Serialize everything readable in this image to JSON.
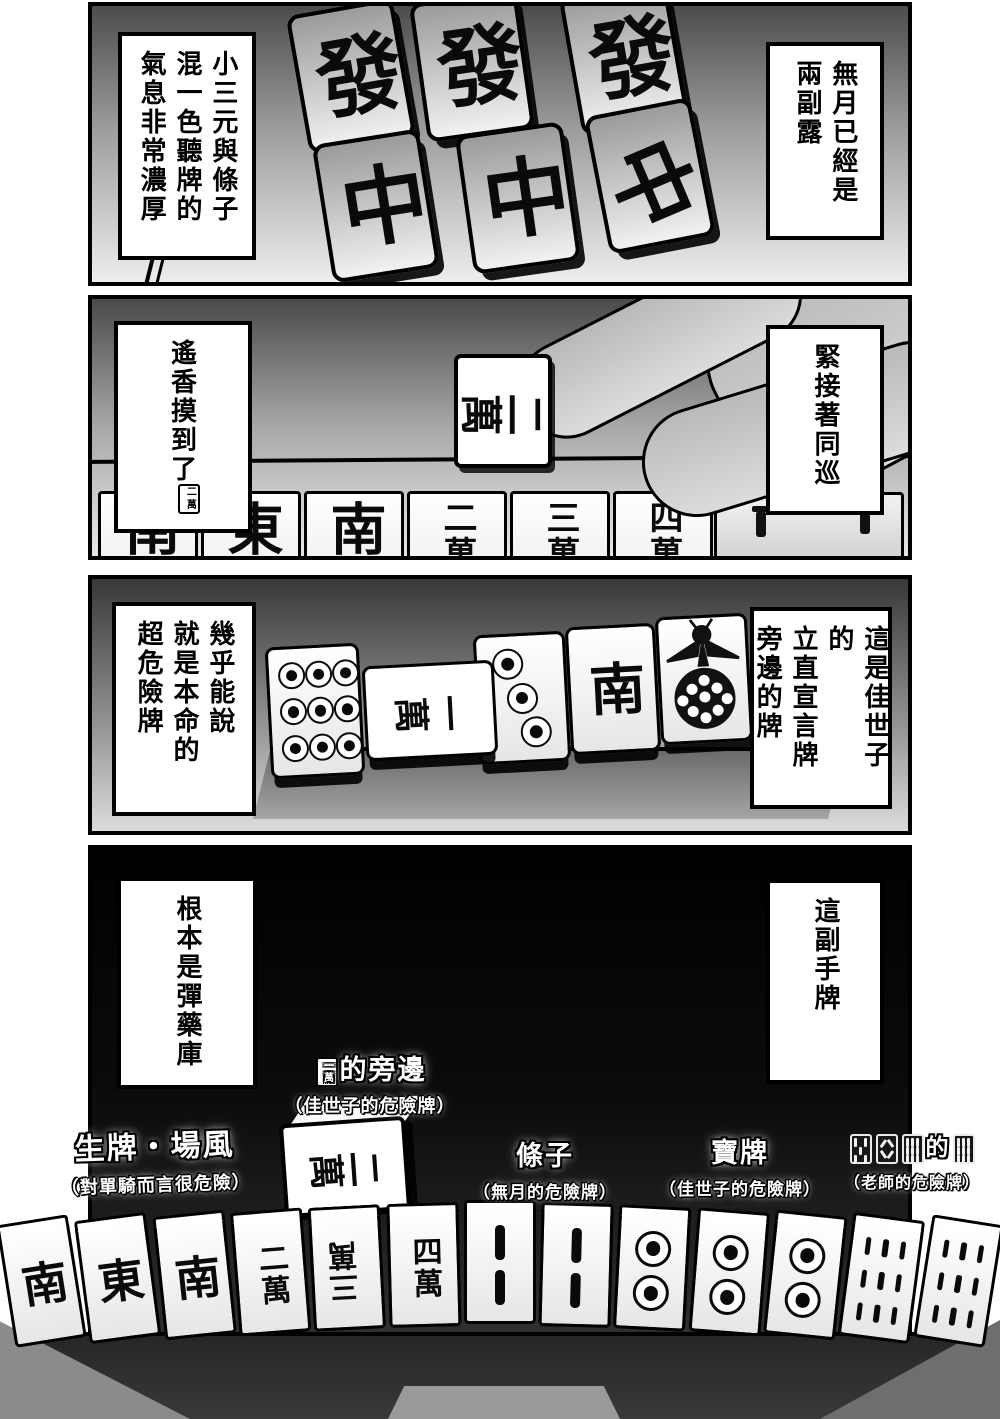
{
  "colors": {
    "ink": "#000000",
    "paper": "#ffffff",
    "panel4_bg": "#000000",
    "label_text": "#ffffff"
  },
  "panel1": {
    "caption_right": "無月已經是\n兩副露",
    "caption_left": "小三元與條子\n混一色聽牌的\n氣息非常濃厚",
    "tiles": [
      {
        "suit": "dragon",
        "label": "發"
      },
      {
        "suit": "dragon",
        "label": "發"
      },
      {
        "suit": "dragon",
        "label": "發"
      },
      {
        "suit": "dragon",
        "label": "中"
      },
      {
        "suit": "dragon",
        "label": "中"
      },
      {
        "suit": "dragon",
        "label": "中"
      }
    ]
  },
  "panel2": {
    "caption_right": "緊接著同巡",
    "caption_left_text": "遙香摸到了",
    "caption_left_icon": {
      "suit": "man",
      "label": "二萬"
    },
    "drawn_tile": {
      "suit": "man",
      "label": "二萬"
    },
    "rack_tiles": [
      {
        "suit": "wind",
        "label": "南"
      },
      {
        "suit": "wind",
        "label": "東"
      },
      {
        "suit": "wind",
        "label": "南"
      },
      {
        "suit": "man",
        "label": "二萬"
      },
      {
        "suit": "man",
        "label": "三萬"
      },
      {
        "suit": "man",
        "label": "四萬"
      }
    ]
  },
  "panel3": {
    "caption_right": "這是佳世子的\n立直宣言牌\n旁邊的牌",
    "caption_left": "幾乎能說\n就是本命的\n超危險牌",
    "discards": [
      {
        "suit": "pin",
        "value": 9,
        "label": "九筒"
      },
      {
        "suit": "man",
        "label": "一萬",
        "rotated": true
      },
      {
        "suit": "pin",
        "value": 3,
        "label": "三筒"
      },
      {
        "suit": "wind",
        "label": "南"
      },
      {
        "suit": "bird",
        "label": "一索"
      }
    ]
  },
  "panel4": {
    "caption_left": "根本是彈藥庫",
    "caption_right": "這副手牌",
    "raised_tile": {
      "suit": "man",
      "label": "二萬"
    },
    "annotations": [
      {
        "id": "soba",
        "icon": {
          "suit": "man",
          "label": "一萬"
        },
        "title": "的旁邊",
        "subtitle": "（佳世子的危險牌）"
      },
      {
        "id": "fresh-wind",
        "title": "生牌・場風",
        "subtitle": "（對單騎而言很危險）"
      },
      {
        "id": "souzu",
        "title": "條子",
        "subtitle": "（無月的危險牌）"
      },
      {
        "id": "dora",
        "title": "寶牌",
        "subtitle": "（佳世子的危險牌）"
      },
      {
        "id": "sou-group",
        "icons": [
          {
            "suit": "sou",
            "value": 5,
            "label": "五索"
          },
          {
            "suit": "sou",
            "value": 8,
            "label": "八索"
          },
          {
            "suit": "sou",
            "value": 9,
            "label": "九索"
          }
        ],
        "title": "的",
        "icon_after": {
          "suit": "sou",
          "value": 9,
          "label": "九索"
        },
        "subtitle": "（老師的危險牌）"
      }
    ],
    "hand": [
      {
        "suit": "wind",
        "label": "南"
      },
      {
        "suit": "wind",
        "label": "東"
      },
      {
        "suit": "wind",
        "label": "南"
      },
      {
        "suit": "man",
        "label": "二萬"
      },
      {
        "suit": "man",
        "label": "三萬",
        "inverted": true
      },
      {
        "suit": "man",
        "label": "四萬"
      },
      {
        "suit": "sou",
        "value": 2,
        "label": "二索"
      },
      {
        "suit": "sou",
        "value": 2,
        "label": "二索"
      },
      {
        "suit": "pin",
        "value": 2,
        "label": "二筒"
      },
      {
        "suit": "pin",
        "value": 2,
        "label": "二筒"
      },
      {
        "suit": "pin",
        "value": 2,
        "label": "二筒"
      },
      {
        "suit": "sou",
        "value": 9,
        "label": "九索"
      },
      {
        "suit": "sou",
        "value": 9,
        "label": "九索"
      }
    ]
  }
}
